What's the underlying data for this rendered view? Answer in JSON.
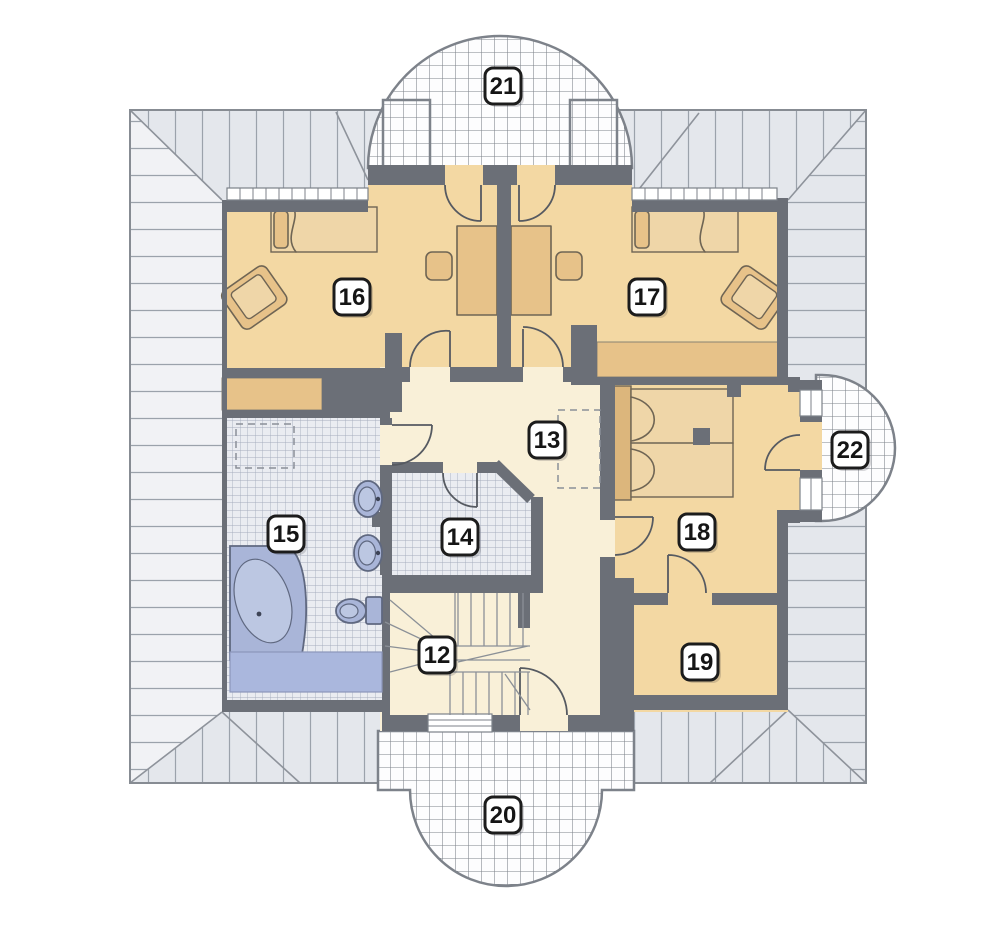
{
  "plan": {
    "type": "floor-plan",
    "storey": "attic",
    "room_numbers": [
      "12",
      "13",
      "14",
      "15",
      "16",
      "17",
      "18",
      "19",
      "20",
      "21",
      "22"
    ]
  },
  "labels": [
    {
      "text": "12"
    },
    {
      "text": "13"
    },
    {
      "text": "14"
    },
    {
      "text": "15"
    },
    {
      "text": "16"
    },
    {
      "text": "17"
    },
    {
      "text": "18"
    },
    {
      "text": "19"
    },
    {
      "text": "20"
    },
    {
      "text": "21"
    },
    {
      "text": "22"
    }
  ],
  "colors": {
    "wall": "#6b6f77",
    "room_floor": "#f3d8a3",
    "hall_floor": "#f9f0d8",
    "furniture": "#e7c289",
    "furniture_light": "#efd6a8",
    "headboard": "#dcb67c",
    "fixture_blue": "#a9b5d8",
    "fixture_blue_light": "#bcc7e2",
    "mat": "#aab7dd",
    "roof_fill": "#e4e7ec",
    "roof_fill_light": "#f1f2f5",
    "hatch_line": "#9ba2ab",
    "tile_fill": "#eaecf1",
    "tile_line": "#a6adbd",
    "balcony_fill": "#fdfdfe",
    "balcony_line": "#7d828a",
    "outline": "#6f747b",
    "label_border": "#1c1c1c",
    "door_line": "#565a61"
  }
}
